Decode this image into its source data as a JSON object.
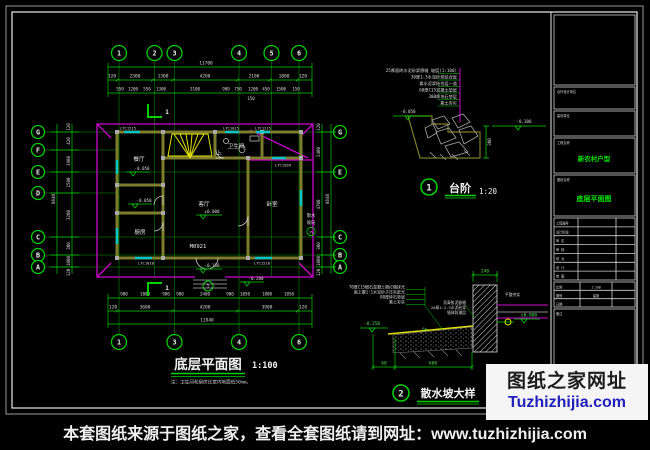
{
  "page": {
    "footer_text": "本套图纸来源于图纸之家，查看全套图纸请到网址：www.tuzhizhijia.com"
  },
  "watermark": {
    "line1": "图纸之家网址",
    "line2": "Tuzhizhijia.com"
  },
  "plan": {
    "title": "底层平面图",
    "scale": "1:100",
    "note": "注：卫生间和厨房比室内地面低50mm。",
    "axes_top": [
      "1",
      "2",
      "3",
      "4",
      "5",
      "6"
    ],
    "axes_bottom": [
      "1",
      "3",
      "4",
      "6"
    ],
    "axes_left": [
      "G",
      "F",
      "E",
      "D",
      "C",
      "B",
      "A"
    ],
    "axes_right": [
      "G",
      "E",
      "C",
      "B",
      "A"
    ],
    "dim_total_top": "11700",
    "top_row2": [
      "120",
      "2300",
      "1300",
      "4200",
      "2100",
      "1800",
      "120"
    ],
    "top_row3": [
      "550",
      "1200",
      "550",
      "1300",
      "3100",
      "900",
      "750",
      "1200",
      "450",
      "1500",
      "150"
    ],
    "top_extra": "150",
    "bottom_row1": [
      "900",
      "1800",
      "900",
      "900",
      "2400",
      "900",
      "1050",
      "1800",
      "1050"
    ],
    "bottom_row2": [
      "120",
      "3600",
      "4200",
      "3900",
      "120"
    ],
    "dim_total_bottom": "11940",
    "left_chain": [
      "120",
      "420",
      "1980",
      "1500",
      "3200",
      "300",
      "1000",
      "120"
    ],
    "left_total": "8640",
    "right_chain": [
      "120",
      "2400",
      "4700",
      "300",
      "1000",
      "120"
    ],
    "right_total": "8640",
    "rooms": [
      "餐厅",
      "厨房",
      "客厅",
      "卧室",
      "卫生间"
    ],
    "stair_up": "上",
    "door_code": "M0921",
    "elevations": {
      "e1": "-0.050",
      "e2": "-0.050",
      "e3": "±0.000",
      "e4": "-0.150",
      "e5": "-0.200"
    },
    "windows": [
      "LTC1515",
      "LTC1015",
      "LTC1215",
      "LTC1509",
      "LTC1818",
      "LTC1518"
    ],
    "apron_dir": "散水",
    "apron_slope": "坡向",
    "apron_pct": "1%",
    "section_cut": "1"
  },
  "detail_steps": {
    "number": "1",
    "title": "台阶",
    "scale": "1:20",
    "layers": [
      "25厚面砖水泥砂浆擦缝 坡度(1:100)",
      "30厚1:3水泥砂浆结合层",
      "素水泥浆结合层一道",
      "60厚C15混凝土垫层",
      "300厚块石垫层",
      "素土夯实"
    ],
    "elev_left": "-0.050",
    "elev_right": "-0.300",
    "dim_height": "300"
  },
  "detail_apron": {
    "number": "2",
    "title": "散水坡大样",
    "layers_left": [
      "70厚C15细石混凝土随打随抹光",
      "面上撒1:1水泥砂子压实赶光",
      "80厚碎石垫层",
      "素土夯实"
    ],
    "layers_mid": [
      "沥青胶泥嵌缝",
      "20厚1:2.5水泥砂浆",
      "墙体防潮层"
    ],
    "note_right": "平整夯实",
    "dim_top": "240",
    "dim_bottom_a": "60",
    "dim_bottom_b": "600",
    "elev_left": "-0.250",
    "elev_right": "±0.000",
    "slope": "6%"
  },
  "titleblock": {
    "s1_label": "合作设计单位",
    "s2_label": "建设单位",
    "s3_label": "工程名称",
    "s3_value": "新农村户型",
    "s4_label": "图纸名称",
    "s4_value": "底层平面图",
    "rows": [
      "工程编号",
      "设计阶段",
      "审 定",
      "审 核",
      "校 对",
      "设 计",
      "制 图"
    ],
    "meta": [
      {
        "k": "比例",
        "v": "1:100"
      },
      {
        "k": "图别",
        "v": "建施"
      },
      {
        "k": "日期",
        "v": ""
      }
    ],
    "note_label": "备注"
  }
}
